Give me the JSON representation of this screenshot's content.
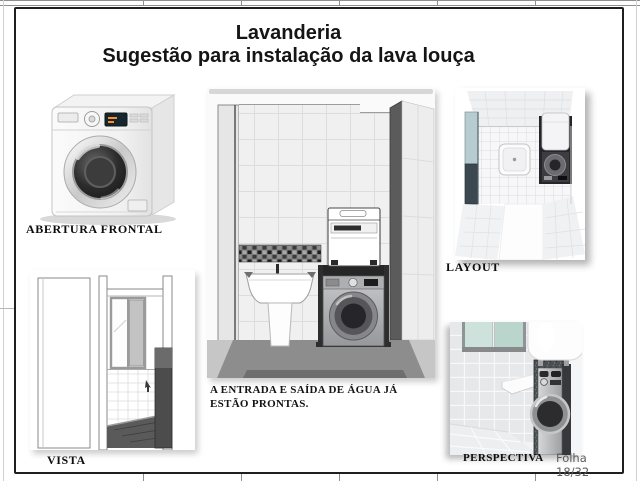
{
  "header": {
    "title": "Lavanderia",
    "subtitle": "Sugestão para instalação da lava louça"
  },
  "figures": {
    "washer": {
      "label": "ABERTURA FRONTAL"
    },
    "center": {
      "note_line1": "A ENTRADA E SAÍDA DE ÁGUA JÁ",
      "note_line2": "ESTÃO PRONTAS."
    },
    "layout": {
      "label": "LAYOUT"
    },
    "vista": {
      "label": "VISTA"
    },
    "perspectiva": {
      "label": "PERSPECTIVA"
    }
  },
  "footer": {
    "sheet": "Folha 18/32"
  },
  "colors": {
    "frame": "#1f1f1f",
    "label_text": "#0d0d0d",
    "sheet_text": "#5c5c5c",
    "window_glass": "#bad6cc",
    "stand_dark": "#2e2e2e",
    "floor_dark": "#8d8d8d"
  }
}
